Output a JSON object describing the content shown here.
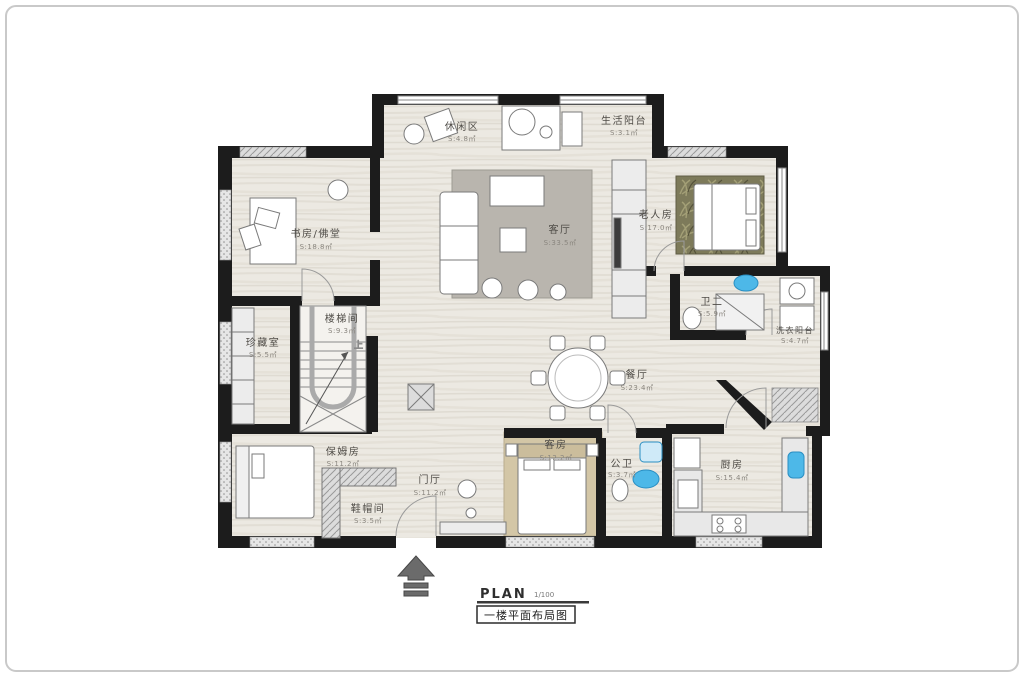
{
  "rooms": [
    {
      "name": "休闲区",
      "area": "S:4.8㎡"
    },
    {
      "name": "生活阳台",
      "area": "S:3.1㎡"
    },
    {
      "name": "书房/佛堂",
      "area": "S:18.8㎡"
    },
    {
      "name": "客厅",
      "area": "S:33.5㎡"
    },
    {
      "name": "老人房",
      "area": "S:17.0㎡"
    },
    {
      "name": "卫二",
      "area": "S:5.9㎡"
    },
    {
      "name": "洗衣阳台",
      "area": "S:4.7㎡"
    },
    {
      "name": "珍藏室",
      "area": "S:5.5㎡"
    },
    {
      "name": "楼梯间",
      "area": "S:9.3㎡"
    },
    {
      "name": "餐厅",
      "area": "S:23.4㎡"
    },
    {
      "name": "保姆房",
      "area": "S:11.2㎡"
    },
    {
      "name": "门厅",
      "area": "S:11.2㎡"
    },
    {
      "name": "客房",
      "area": "S:12.2㎡"
    },
    {
      "name": "公卫",
      "area": "S:3.7㎡"
    },
    {
      "name": "厨房",
      "area": "S:15.4㎡"
    },
    {
      "name": "鞋帽间",
      "area": "S:3.5㎡"
    }
  ],
  "stairs": {
    "up_label": "上"
  },
  "titleblock": {
    "plan": "PLAN",
    "scale": "1/100",
    "caption": "一楼平面布局图"
  },
  "colors": {
    "wall": "#1c1c1c",
    "floor": "#ece9e2",
    "rug_gray": "#b9b5ae",
    "rug_tan": "#d3c6a6",
    "rug_olive": "#7d7a5a",
    "fixture_blue": "#4db8e8"
  }
}
